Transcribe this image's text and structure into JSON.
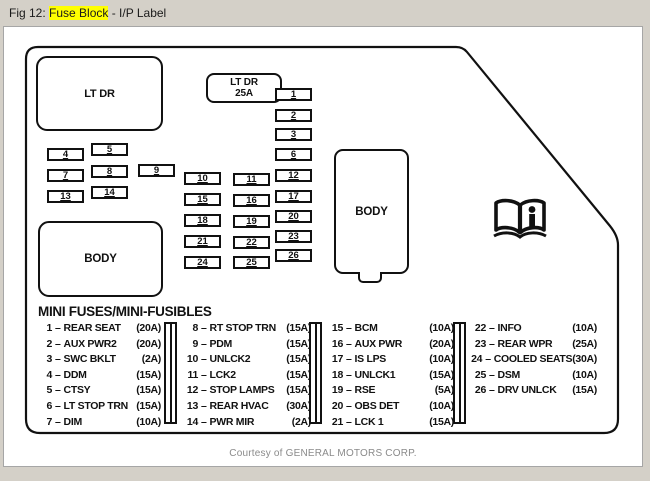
{
  "window": {
    "title_prefix": "Fig 12: ",
    "title_highlight": "Fuse Block",
    "title_suffix": " - I/P Label",
    "highlight_color": "#ffff00"
  },
  "diagram": {
    "boxes": {
      "lt_dr": "LT DR",
      "lt_dr_fuse_line1": "LT DR",
      "lt_dr_fuse_line2": "25A",
      "body_left": "BODY",
      "body_right": "BODY"
    },
    "fuses": [
      "1",
      "2",
      "3",
      "4",
      "5",
      "6",
      "7",
      "8",
      "9",
      "10",
      "11",
      "12",
      "13",
      "14",
      "15",
      "16",
      "17",
      "18",
      "19",
      "20",
      "21",
      "22",
      "23",
      "24",
      "25",
      "26"
    ],
    "icons": {
      "book": "owner-manual-book-icon"
    }
  },
  "legend": {
    "title": "MINI FUSES/MINI-FUSIBLES",
    "separator": "–",
    "columns": [
      [
        {
          "num": "1",
          "label": "REAR SEAT",
          "amp": "(20A)"
        },
        {
          "num": "2",
          "label": "AUX PWR2",
          "amp": "(20A)"
        },
        {
          "num": "3",
          "label": "SWC BKLT",
          "amp": "(2A)"
        },
        {
          "num": "4",
          "label": "DDM",
          "amp": "(15A)"
        },
        {
          "num": "5",
          "label": "CTSY",
          "amp": "(15A)"
        },
        {
          "num": "6",
          "label": "LT STOP TRN",
          "amp": "(15A)"
        },
        {
          "num": "7",
          "label": "DIM",
          "amp": "(10A)"
        }
      ],
      [
        {
          "num": "8",
          "label": "RT STOP TRN",
          "amp": "(15A)"
        },
        {
          "num": "9",
          "label": "PDM",
          "amp": "(15A)"
        },
        {
          "num": "10",
          "label": "UNLCK2",
          "amp": "(15A)"
        },
        {
          "num": "11",
          "label": "LCK2",
          "amp": "(15A)"
        },
        {
          "num": "12",
          "label": "STOP LAMPS",
          "amp": "(15A)"
        },
        {
          "num": "13",
          "label": "REAR HVAC",
          "amp": "(30A)"
        },
        {
          "num": "14",
          "label": "PWR MIR",
          "amp": "(2A)"
        }
      ],
      [
        {
          "num": "15",
          "label": "BCM",
          "amp": "(10A)"
        },
        {
          "num": "16",
          "label": "AUX PWR",
          "amp": "(20A)"
        },
        {
          "num": "17",
          "label": "IS LPS",
          "amp": "(10A)"
        },
        {
          "num": "18",
          "label": "UNLCK1",
          "amp": "(15A)"
        },
        {
          "num": "19",
          "label": "RSE",
          "amp": "(5A)"
        },
        {
          "num": "20",
          "label": "OBS DET",
          "amp": "(10A)"
        },
        {
          "num": "21",
          "label": "LCK 1",
          "amp": "(15A)"
        }
      ],
      [
        {
          "num": "22",
          "label": "INFO",
          "amp": "(10A)"
        },
        {
          "num": "23",
          "label": "REAR WPR",
          "amp": "(25A)"
        },
        {
          "num": "24",
          "label": "COOLED SEATS",
          "amp": "(30A)"
        },
        {
          "num": "25",
          "label": "DSM",
          "amp": "(10A)"
        },
        {
          "num": "26",
          "label": "DRV UNLCK",
          "amp": "(15A)"
        }
      ]
    ]
  },
  "footer": {
    "credit": "Courtesy of GENERAL MOTORS CORP."
  }
}
